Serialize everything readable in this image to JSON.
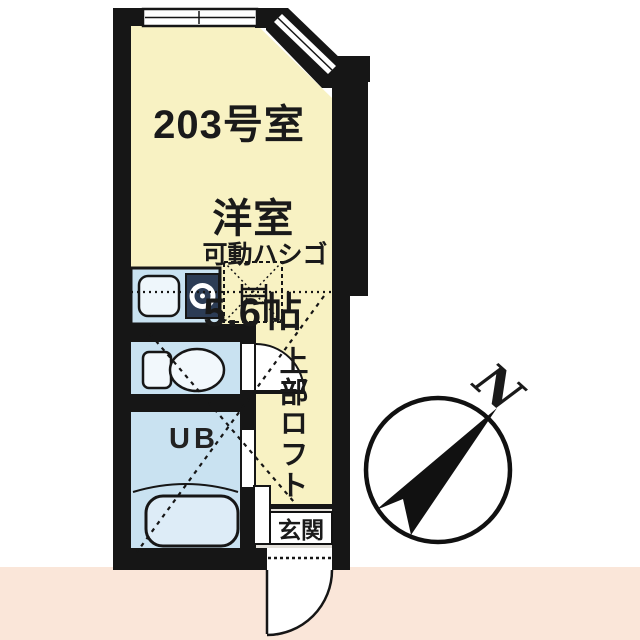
{
  "room": {
    "number": "203号室",
    "type": "洋室",
    "size": "5.6帖"
  },
  "labels": {
    "ladder": "可動ハシゴ",
    "loft": "上部ロフト",
    "entrance": "玄関",
    "unit_bath": "UB",
    "north": "N"
  },
  "colors": {
    "room": "#f8f2c3",
    "water": "#c9e2f1",
    "wall": "#161616",
    "pink": "#fae6d9",
    "genkan": "#e3e0da"
  }
}
